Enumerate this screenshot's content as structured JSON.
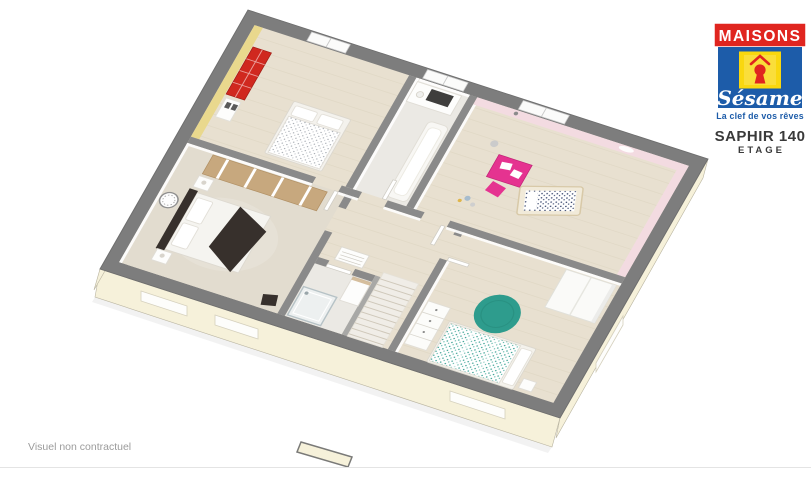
{
  "brand": {
    "wordmark": "MAISONS",
    "script": "Sésame",
    "tagline": "La clef de vos rêves",
    "colors": {
      "red": "#e0251f",
      "blue": "#1d5ca9",
      "yellow": "#f9d70f"
    }
  },
  "plan": {
    "title": "SAPHIR 140",
    "subtitle": "ETAGE"
  },
  "footer": {
    "disclaimer": "Visuel non contractuel"
  },
  "floorplan": {
    "colors": {
      "wall_cut": "#7d7d7d",
      "partition": "#8a8a8a",
      "facade": "#f6f1da",
      "floor_wood": "#e8e0d0",
      "floor_tile": "#ebe9e4",
      "carpet": "#e2dccf",
      "yellow_wall": "#e9d88d",
      "pink_wall": "#f3dbe1",
      "bookcase_red": "#d0281f",
      "desk_pink": "#e53390",
      "rug_teal": "#2e9c8d",
      "dark_textile": "#37302c",
      "wood_furniture": "#c7a87e"
    }
  }
}
